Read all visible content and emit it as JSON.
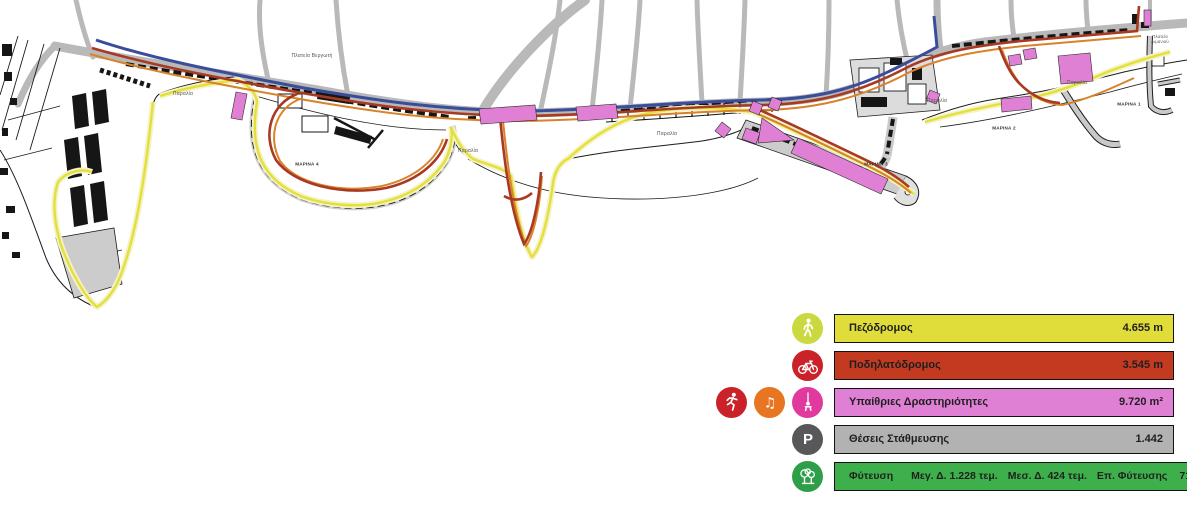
{
  "map": {
    "labels": [
      {
        "text": "Πλατεία Βεργωτή",
        "x": 312,
        "y": 56,
        "cls": "place"
      },
      {
        "text": "Παραλία",
        "x": 183,
        "y": 94,
        "cls": "place"
      },
      {
        "text": "ΜΑΡΙΝΑ 4",
        "x": 307,
        "y": 164,
        "cls": "marina"
      },
      {
        "text": "Παραλία",
        "x": 468,
        "y": 151,
        "cls": "place"
      },
      {
        "text": "Παραλία",
        "x": 667,
        "y": 134,
        "cls": "place"
      },
      {
        "text": "ΜΑΡΙΝΑ 3",
        "x": 876,
        "y": 164,
        "cls": "marina"
      },
      {
        "text": "Παραλία",
        "x": 937,
        "y": 101,
        "cls": "place"
      },
      {
        "text": "ΜΑΡΙΝΑ 2",
        "x": 1004,
        "y": 128,
        "cls": "marina"
      },
      {
        "text": "Παραλία",
        "x": 1077,
        "y": 83,
        "cls": "place"
      },
      {
        "text": "ΜΑΡΙΝΑ 1",
        "x": 1129,
        "y": 104,
        "cls": "marina"
      },
      {
        "text": "Πλατεία Λιμανιού",
        "x": 1160,
        "y": 40,
        "cls": "two-line"
      }
    ],
    "colors": {
      "pedestrian_route": "#e3df3b",
      "pedestrian_halo": "#f5f2c6",
      "bike_route": "#a93a22",
      "secondary_route": "#d8822a",
      "main_axis_route": "#3a4d9b",
      "road": "#b9b9b9",
      "activity_area": "#df80d5",
      "building": "#161616",
      "coastline": "#1c1c1c"
    }
  },
  "glyphs": {
    "music_note": "♫",
    "parking": "P"
  },
  "legend": {
    "rows": [
      {
        "label": "Πεζόδρομος",
        "value": "4.655 m",
        "bar_color": "#e0dd3a",
        "icon": "walking-person",
        "icon_color": "#ccd840"
      },
      {
        "label": "Ποδηλατόδρομος",
        "value": "3.545 m",
        "bar_color": "#c33a21",
        "icon": "bicycle",
        "icon_color": "#cb2128"
      },
      {
        "label": "Υπαίθριες Δραστηριότητες",
        "value": "9.720 m²",
        "bar_color": "#df80d5",
        "icon": "swing",
        "icon_color": "#e13a9f",
        "extra_icons": [
          {
            "name": "runner",
            "color": "#cb2128"
          },
          {
            "name": "music-note",
            "color": "#e87522"
          }
        ]
      },
      {
        "label": "Θέσεις Στάθμευσης",
        "value": "1.442",
        "bar_color": "#b2b2b2",
        "icon": "parking",
        "icon_color": "#58585a"
      },
      {
        "label": "Φύτευση",
        "details": [
          "Μεγ. Δ. 1.228 τεμ.",
          "Μεσ. Δ. 424 τεμ.",
          "Επ. Φύτευσης"
        ],
        "value": "71.200 m²",
        "bar_color": "#3eb04b",
        "icon": "trees",
        "icon_color": "#2f9e48"
      }
    ]
  }
}
